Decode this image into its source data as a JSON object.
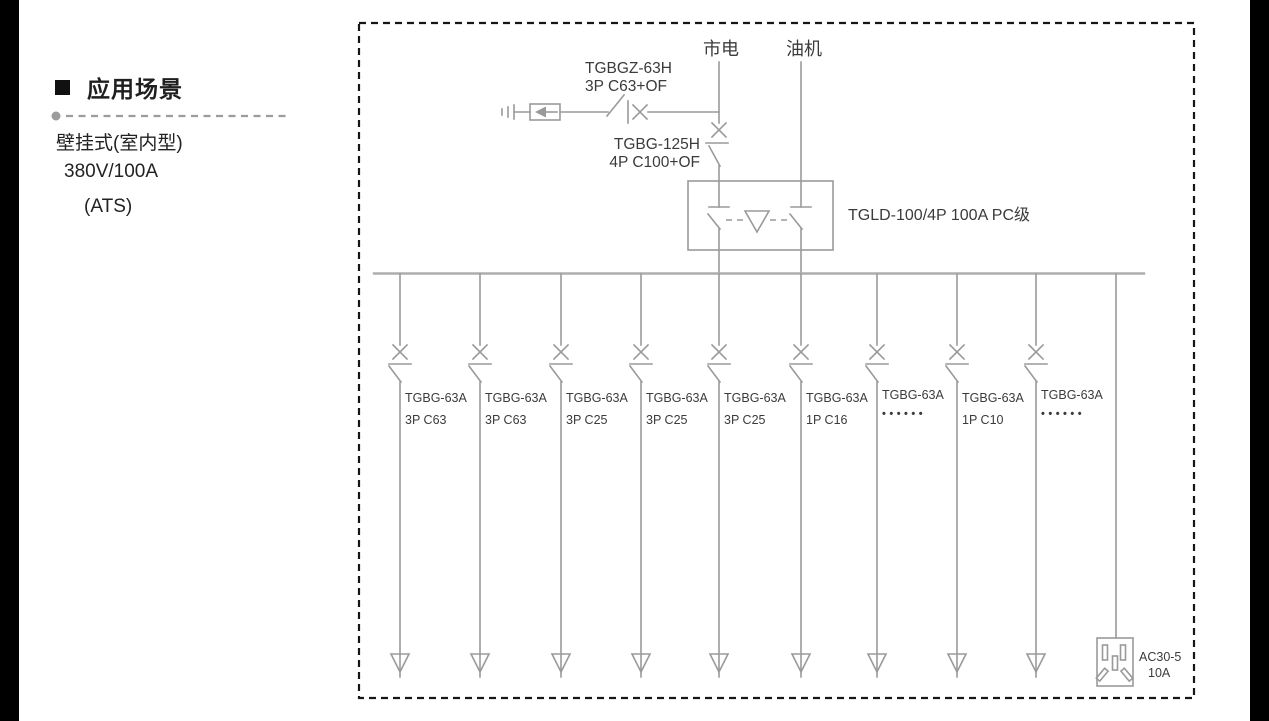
{
  "colors": {
    "line": "#9a9a9a",
    "text": "#3b3b3b",
    "border": "#161616"
  },
  "panel": {
    "section_title": "应用场景",
    "scenario_lines": [
      "壁挂式(室内型)",
      "380V/100A",
      "(ATS)"
    ]
  },
  "diagram": {
    "sources": {
      "mains": "市电",
      "generator": "油机"
    },
    "spd_breaker": {
      "model": "TGBGZ-63H",
      "spec": "3P C63+OF"
    },
    "incoming_breaker": {
      "model": "TGBG-125H",
      "spec": "4P C100+OF"
    },
    "ats_label": "TGLD-100/4P 100A PC级",
    "branches": [
      {
        "model": "TGBG-63A",
        "spec": "3P C63"
      },
      {
        "model": "TGBG-63A",
        "spec": "3P C63"
      },
      {
        "model": "TGBG-63A",
        "spec": "3P C25"
      },
      {
        "model": "TGBG-63A",
        "spec": "3P C25"
      },
      {
        "model": "TGBG-63A",
        "spec": "3P C25"
      },
      {
        "model": "TGBG-63A",
        "spec": "1P C16"
      },
      {
        "model": "TGBG-63A",
        "spec": "••••••"
      },
      {
        "model": "TGBG-63A",
        "spec": "1P C10"
      },
      {
        "model": "TGBG-63A",
        "spec": "••••••"
      }
    ],
    "socket": {
      "model": "AC30-5",
      "rating": "10A"
    }
  }
}
